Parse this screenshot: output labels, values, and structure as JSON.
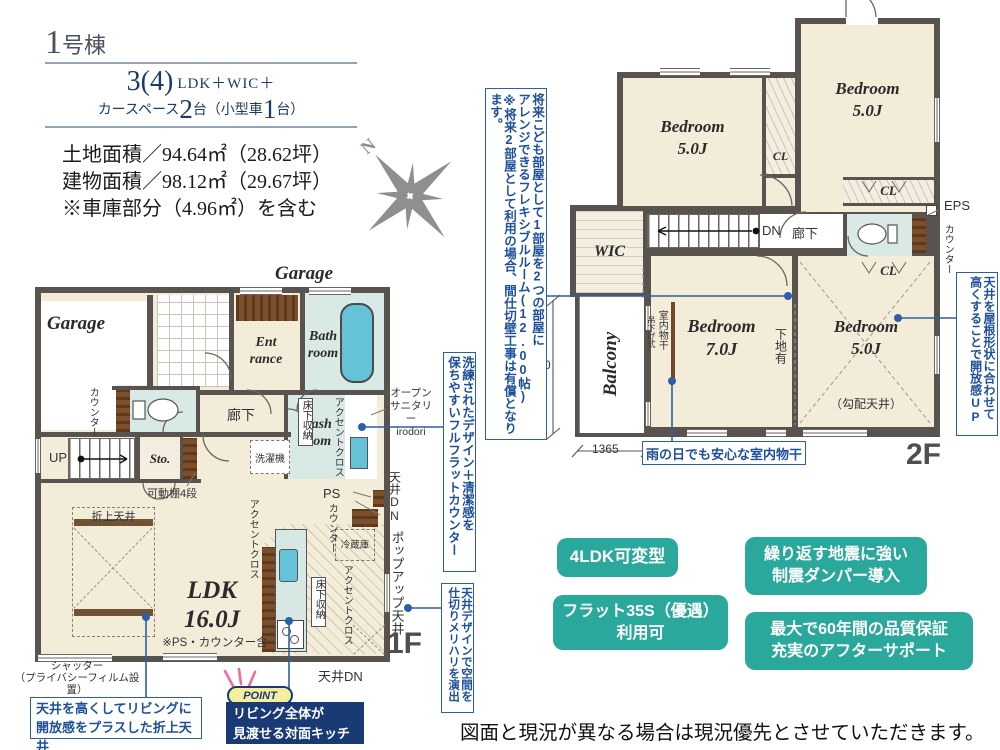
{
  "title_block": {
    "building_num": "1",
    "building_suffix": "号棟",
    "layout_num": "3(4)",
    "layout_rest": "LDK＋WIC＋",
    "car_pre": "カースペース",
    "car_n1": "2",
    "car_mid": "台（小型車",
    "car_n2": "1",
    "car_end": "台）",
    "areas": "土地面積／94.64㎡（28.62坪）\n建物面積／98.12㎡（29.67坪）\n※車庫部分（4.96㎡）を含む"
  },
  "compass": {
    "north": "N"
  },
  "floor1": {
    "name": "1F",
    "garage_top": "Garage",
    "garage_left": "Garage",
    "entrance": "Ent\nrance",
    "bathroom": "Bath\nroom",
    "washroom": "Wash\nroom",
    "storage": "Sto.",
    "hallway": "廊下",
    "up": "UP",
    "counter_side": "カウンター",
    "shelf": "可動棚4段",
    "washer": "洗濯機",
    "underfloor_wash": "床下収納",
    "underfloor_kitchen": "床下収納",
    "accent_wash": "アクセントクロス",
    "accent_ldk": "アクセントクロス",
    "accent_kitchen": "アクセントクロス",
    "open_sanitary": "オープン\nサニタリー\nirodori",
    "ldk": "LDK\n16.0J",
    "ldk_note": "※PS・カウンター含",
    "folded_ceiling": "折上天井",
    "fridge": "冷蔵庫",
    "ps": "PS",
    "counter_kitchen": "カウンター",
    "ceiling_dn_right": "天井DN",
    "popup_ceiling": "ポップアップ天井",
    "ceiling_dn_bottom": "天井DN",
    "shutter": "シャッター\n（プライバシーフィルム設置）"
  },
  "floor2": {
    "name": "2F",
    "bedroom_nw": "Bedroom\n5.0J",
    "bedroom_ne": "Bedroom\n5.0J",
    "bedroom_sw": "Bedroom\n7.0J",
    "bedroom_se": "Bedroom\n5.0J",
    "sloped_ceiling": "（勾配天井）",
    "wic": "WIC",
    "balcony": "Balcony",
    "cl_mid": "CL",
    "cl_right_top": "CL",
    "cl_right_bottom": "CL",
    "dn": "DN",
    "hallway": "廊下",
    "eps": "EPS",
    "counter": "カウンター",
    "drying_pole": "室内物干",
    "drying_type": "吊下げ式",
    "backing": "下地有",
    "dim_height": "2730",
    "dim_width": "1365"
  },
  "annotations": {
    "flexible_room": "将来こども部屋として1部屋を2つの部屋に\nアレンジできるフレキシブルルーム(12.00帖)\n※将来2部屋として利用の場合、間仕切壁工事は有償となります。",
    "flat_counter": "洗練されたデザイン＋清潔感を\n保ちやすいフルフラットカウンター",
    "ceiling_zoning": "天井デザインで空間を\n仕切りメリハリを演出",
    "open_feel": "天井を屋根形状に合わせて\n高くすることで開放感UP",
    "indoor_drying": "雨の日でも安心な室内物干",
    "folded_ceiling": "天井を高くしてリビングに\n開放感をプラスした折上天井",
    "point_badge": "POINT",
    "point_text": "リビング全体が\n見渡せる対面キッチン"
  },
  "badges": {
    "b1": "4LDK可変型",
    "b2": "フラット35S（優遇）\n利用可",
    "b3": "繰り返す地震に強い\n制震ダンパー導入",
    "b4": "最大で60年間の品質保証\n充実のアフターサポート"
  },
  "footer": {
    "disclaimer": "図面と現況が異なる場合は現況優先とさせていただきます。"
  },
  "colors": {
    "accent_blue": "#2b5fa7",
    "teal": "#2ba89c",
    "navy": "#1a3a75",
    "wall": "#59534f",
    "floor": "#f2ecd8",
    "wet": "#d9e9e5",
    "tub": "#66c2d6"
  }
}
